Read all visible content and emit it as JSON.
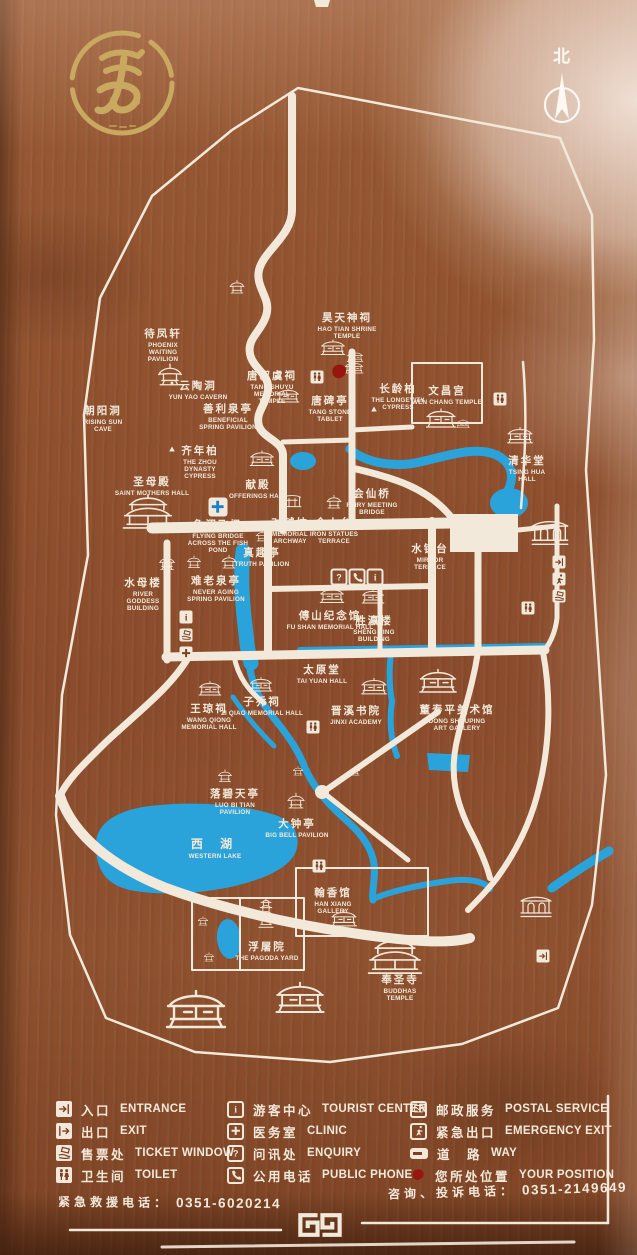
{
  "board": {
    "north_label": "北"
  },
  "colors": {
    "board": "#8f5130",
    "board_dark": "#7a4123",
    "line": "#f2e9da",
    "water": "#2aa3db",
    "water_dark": "#1d7fc4",
    "gold": "#c9a85f",
    "red": "#991510"
  },
  "map": {
    "places": [
      {
        "zh": "待凤轩",
        "en": "PHOENIX WAITING PAVILION",
        "x": 163,
        "y": 326,
        "w": 56
      },
      {
        "zh": "昊天神祠",
        "en": "HAO TIAN SHRINE TEMPLE",
        "x": 347,
        "y": 310,
        "w": 60
      },
      {
        "zh": "云陶洞",
        "en": "YUN YAO CAVERN",
        "x": 198,
        "y": 378,
        "w": 70
      },
      {
        "zh": "唐叔虞祠",
        "en": "TANG SHUYU MEMORIAL TEMPLE",
        "x": 272,
        "y": 368,
        "w": 58
      },
      {
        "zh": "朝阳洞",
        "en": "RISING SUN CAVE",
        "x": 103,
        "y": 403,
        "w": 44
      },
      {
        "zh": "善利泉亭",
        "en": "BENEFICIAL SPRING PAVILION",
        "x": 228,
        "y": 401,
        "w": 66
      },
      {
        "zh": "唐碑亭",
        "en": "TANG STONE TABLET",
        "x": 330,
        "y": 393,
        "w": 44
      },
      {
        "zh": "长龄柏",
        "en": "THE LONGEVITY CYPRESS",
        "x": 398,
        "y": 381,
        "w": 54
      },
      {
        "zh": "文昌宫",
        "en": "WEN CHANG TEMPLE",
        "x": 447,
        "y": 383,
        "w": 90
      },
      {
        "zh": "清华堂",
        "en": "TSING HUA HALL",
        "x": 527,
        "y": 453,
        "w": 44
      },
      {
        "zh": "齐年柏",
        "en": "THE ZHOU DYNASTY CYPRESS",
        "x": 200,
        "y": 443,
        "w": 64
      },
      {
        "zh": "圣母殿",
        "en": "SAINT MOTHERS HALL",
        "x": 152,
        "y": 474,
        "w": 86
      },
      {
        "zh": "献殿",
        "en": "OFFERINGS HALL",
        "x": 258,
        "y": 477,
        "w": 70
      },
      {
        "zh": "会仙桥",
        "en": "FAIRY MEETING BRIDGE",
        "x": 372,
        "y": 486,
        "w": 52
      },
      {
        "zh": "鱼沼飞梁",
        "en": "FLYING BRIDGE ACROSS THE FISH POND",
        "x": 218,
        "y": 517,
        "w": 74
      },
      {
        "zh": "对越坊",
        "en": "MEMORIAL ARCHWAY",
        "x": 290,
        "y": 515,
        "w": 46
      },
      {
        "zh": "金人台",
        "en": "IRON STATUES TERRACE",
        "x": 334,
        "y": 515,
        "w": 56
      },
      {
        "zh": "真趣亭",
        "en": "TRUTH PAVILION",
        "x": 262,
        "y": 545,
        "w": 60
      },
      {
        "zh": "水镜台",
        "en": "MIRROR TERRACE",
        "x": 430,
        "y": 541,
        "w": 60
      },
      {
        "zh": "水母楼",
        "en": "RIVER GODDESS BUILDING",
        "x": 143,
        "y": 575,
        "w": 46
      },
      {
        "zh": "难老泉亭",
        "en": "NEVER AGING SPRING PAVILION",
        "x": 216,
        "y": 573,
        "w": 60
      },
      {
        "zh": "傅山纪念馆",
        "en": "FU SHAN MEMORIAL HALL",
        "x": 330,
        "y": 608,
        "w": 88
      },
      {
        "zh": "胜瀛楼",
        "en": "SHENG YING BUILDING",
        "x": 374,
        "y": 613,
        "w": 44
      },
      {
        "zh": "太原堂",
        "en": "TAI YUAN HALL",
        "x": 322,
        "y": 662,
        "w": 60
      },
      {
        "zh": "王琼祠",
        "en": "WANG QIONG MEMORIAL HALL",
        "x": 209,
        "y": 701,
        "w": 56
      },
      {
        "zh": "子乔祠",
        "en": "ZI QIAO MEMORIAL HALL",
        "x": 262,
        "y": 694,
        "w": 86
      },
      {
        "zh": "晋溪书院",
        "en": "JINXI ACADEMY",
        "x": 356,
        "y": 703,
        "w": 60
      },
      {
        "zh": "董寿平美术馆",
        "en": "DONG SHOUPING ART GALLERY",
        "x": 457,
        "y": 702,
        "w": 66
      },
      {
        "zh": "落碧天亭",
        "en": "LUO BI TIAN PAVILION",
        "x": 235,
        "y": 786,
        "w": 66
      },
      {
        "zh": "大钟亭",
        "en": "BIG BELL PAVILION",
        "x": 297,
        "y": 816,
        "w": 64
      },
      {
        "zh": "西 湖",
        "en": "WESTERN LAKE",
        "x": 215,
        "y": 835,
        "w": 60,
        "cls": "lake"
      },
      {
        "zh": "翰香馆",
        "en": "HAN XIANG GALLERY",
        "x": 333,
        "y": 885,
        "w": 40
      },
      {
        "zh": "浮屠院",
        "en": "THE PAGODA YARD",
        "x": 267,
        "y": 939,
        "w": 74
      },
      {
        "zh": "奉圣寺",
        "en": "BUDDHAS TEMPLE",
        "x": 400,
        "y": 972,
        "w": 60
      }
    ],
    "buildings": [
      [
        "pavilion",
        237,
        287,
        16
      ],
      [
        "pavilion",
        170,
        375,
        26
      ],
      [
        "hall",
        333,
        348,
        26
      ],
      [
        "hall",
        355,
        357,
        18
      ],
      [
        "hall",
        288,
        396,
        24
      ],
      [
        "hall",
        354,
        368,
        20
      ],
      [
        "hall",
        441,
        419,
        32
      ],
      [
        "hall",
        463,
        424,
        15
      ],
      [
        "hall",
        520,
        436,
        28
      ],
      [
        "bighall",
        148,
        512,
        54
      ],
      [
        "hall",
        262,
        459,
        26
      ],
      [
        "arch",
        292,
        501,
        20
      ],
      [
        "pavilion",
        334,
        502,
        16
      ],
      [
        "pavilion",
        262,
        536,
        13
      ],
      [
        "pavilion",
        167,
        563,
        17
      ],
      [
        "pavilion",
        194,
        562,
        15
      ],
      [
        "pavilion",
        229,
        562,
        16
      ],
      [
        "hall",
        332,
        596,
        26
      ],
      [
        "hall",
        373,
        597,
        24
      ],
      [
        "hall",
        210,
        689,
        24
      ],
      [
        "hall",
        261,
        685,
        24
      ],
      [
        "hall",
        374,
        687,
        28
      ],
      [
        "hall",
        438,
        682,
        40
      ],
      [
        "pavilion",
        225,
        776,
        15
      ],
      [
        "pavilion",
        298,
        771,
        11
      ],
      [
        "pavilion",
        355,
        771,
        11
      ],
      [
        "pavilion",
        296,
        801,
        19
      ],
      [
        "hall",
        344,
        919,
        28
      ],
      [
        "pagoda",
        266,
        913,
        18
      ],
      [
        "pavilion",
        203,
        921,
        11
      ],
      [
        "pavilion",
        209,
        957,
        11
      ],
      [
        "bighall",
        395,
        956,
        58
      ],
      [
        "gate",
        550,
        532,
        40
      ],
      [
        "gate",
        536,
        906,
        34
      ],
      [
        "hall",
        196,
        1011,
        64
      ],
      [
        "hall",
        300,
        999,
        52
      ]
    ],
    "facilities": [
      [
        "toilet",
        317,
        377,
        "solid"
      ],
      [
        "position",
        339,
        372,
        "plain"
      ],
      [
        "toilet",
        500,
        399,
        "solid"
      ],
      [
        "clinic",
        218,
        507,
        "blue"
      ],
      [
        "enquiry",
        339,
        577,
        "outline"
      ],
      [
        "phone",
        357,
        577,
        "outline"
      ],
      [
        "info",
        375,
        577,
        "outline"
      ],
      [
        "info",
        186,
        617,
        "solid"
      ],
      [
        "ticket",
        186,
        635,
        "solid"
      ],
      [
        "clinic",
        186,
        653,
        "solid"
      ],
      [
        "toilet",
        528,
        608,
        "solid"
      ],
      [
        "entrance",
        559,
        562,
        "solid"
      ],
      [
        "emergency",
        559,
        579,
        "solid"
      ],
      [
        "ticket",
        559,
        596,
        "solid"
      ],
      [
        "toilet",
        313,
        727,
        "solid"
      ],
      [
        "toilet",
        319,
        866,
        "solid"
      ],
      [
        "entrance",
        543,
        956,
        "solid"
      ],
      [
        "dot",
        172,
        383,
        "plain"
      ],
      [
        "triangle",
        374,
        409,
        "plain"
      ],
      [
        "triangle",
        172,
        449,
        "plain"
      ]
    ]
  },
  "legend": {
    "columns": [
      [
        {
          "t": "entrance",
          "zh": "入口",
          "en": "ENTRANCE",
          "style": "solid"
        },
        {
          "t": "exit",
          "zh": "出口",
          "en": "EXIT",
          "style": "solid"
        },
        {
          "t": "ticket",
          "zh": "售票处",
          "en": "TICKET WINDOW",
          "style": "solid"
        },
        {
          "t": "toilet",
          "zh": "卫生间",
          "en": "TOILET",
          "style": "solid"
        }
      ],
      [
        {
          "t": "info",
          "zh": "游客中心",
          "en": "TOURIST CENTER",
          "style": "outline"
        },
        {
          "t": "clinic",
          "zh": "医务室",
          "en": "CLINIC",
          "style": "outline"
        },
        {
          "t": "enquiry",
          "zh": "问讯处",
          "en": "ENQUIRY",
          "style": "outline"
        },
        {
          "t": "phone",
          "zh": "公用电话",
          "en": "PUBLIC PHONE",
          "style": "outline"
        }
      ],
      [
        {
          "t": "postal",
          "zh": "邮政服务",
          "en": "POSTAL SERVICE",
          "style": "outline"
        },
        {
          "t": "emergency",
          "zh": "紧急出口",
          "en": "EMERGENCY EXIT",
          "style": "outline"
        },
        {
          "t": "way",
          "zh": "道　路",
          "en": "WAY",
          "style": "way"
        },
        {
          "t": "position",
          "zh": "您所处位置",
          "en": "YOUR POSITION",
          "style": "position"
        }
      ]
    ]
  },
  "footer": {
    "emergency_label": "紧急救援电话：",
    "emergency_number": "0351-6020214",
    "consult_label": "咨询、投诉电话：",
    "consult_number": "0351-2149649"
  }
}
